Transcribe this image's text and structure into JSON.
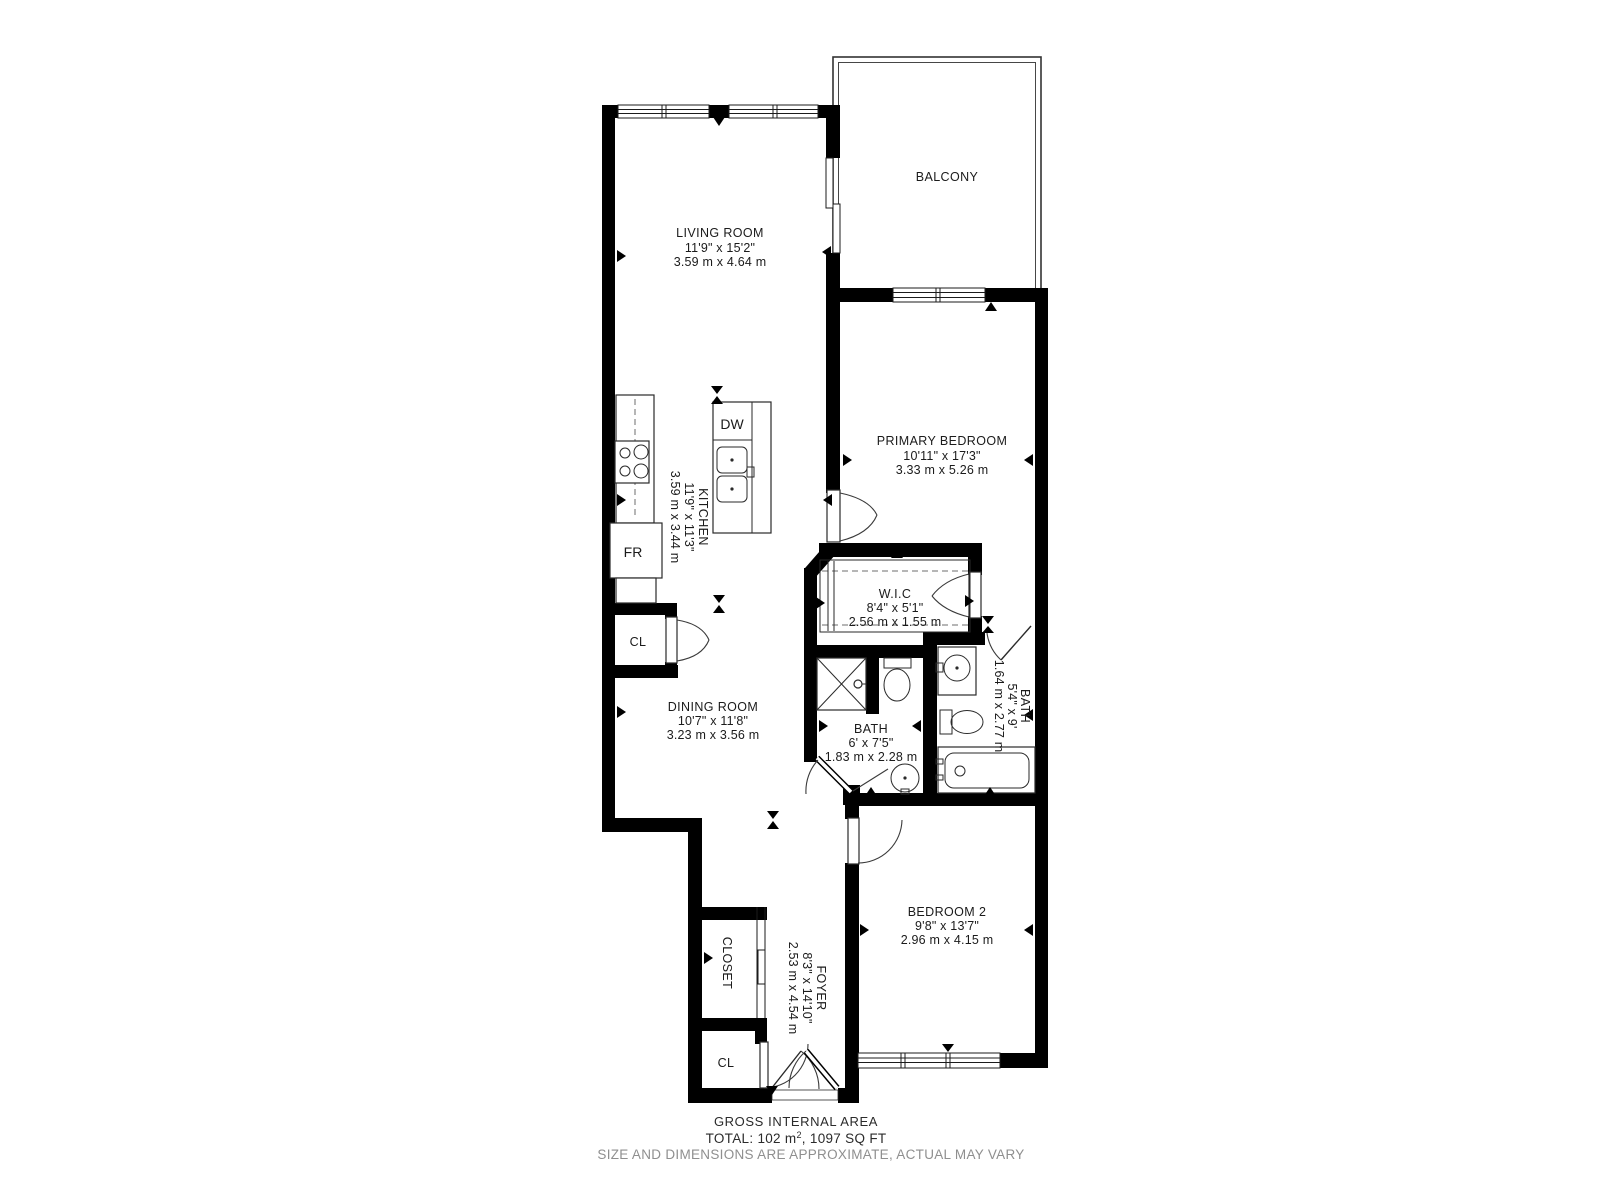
{
  "colors": {
    "wall": "#000000",
    "text": "#1b1b1b",
    "disclaimer": "#8f8f8f"
  },
  "rooms": {
    "balcony": {
      "name": "BALCONY"
    },
    "living": {
      "name": "LIVING ROOM",
      "imperial": "11'9\" x 15'2\"",
      "metric": "3.59 m x 4.64 m"
    },
    "primary": {
      "name": "PRIMARY BEDROOM",
      "imperial": "10'11\" x 17'3\"",
      "metric": "3.33 m x 5.26 m"
    },
    "kitchen": {
      "name": "KITCHEN",
      "imperial": "11'9\" x 11'3\"",
      "metric": "3.59 m x 3.44 m"
    },
    "wic": {
      "name": "W.I.C",
      "imperial": "8'4\" x 5'1\"",
      "metric": "2.56 m x 1.55 m"
    },
    "bath_ensuite": {
      "name": "BATH",
      "imperial": "5'4\" x 9'",
      "metric": "1.64 m x 2.77 m"
    },
    "bath": {
      "name": "BATH",
      "imperial": "6' x 7'5\"",
      "metric": "1.83 m x 2.28 m"
    },
    "dining": {
      "name": "DINING ROOM",
      "imperial": "10'7\" x 11'8\"",
      "metric": "3.23 m x 3.56 m"
    },
    "bedroom2": {
      "name": "BEDROOM 2",
      "imperial": "9'8\" x 13'7\"",
      "metric": "2.96 m x 4.15 m"
    },
    "foyer": {
      "name": "FOYER",
      "imperial": "8'3\" x 14'10\"",
      "metric": "2.53 m x 4.54 m"
    },
    "closet": {
      "name": "CLOSET"
    },
    "cl_kitchen": {
      "name": "CL"
    },
    "cl_foyer": {
      "name": "CL"
    }
  },
  "fixtures": {
    "dishwasher": "DW",
    "fridge": "FR"
  },
  "footer": {
    "line1": "GROSS INTERNAL AREA",
    "total_prefix": "TOTAL: 102 m",
    "total_sup": "2",
    "total_suffix": ", 1097 SQ FT",
    "disclaimer": "SIZE AND DIMENSIONS ARE APPROXIMATE, ACTUAL MAY VARY"
  }
}
